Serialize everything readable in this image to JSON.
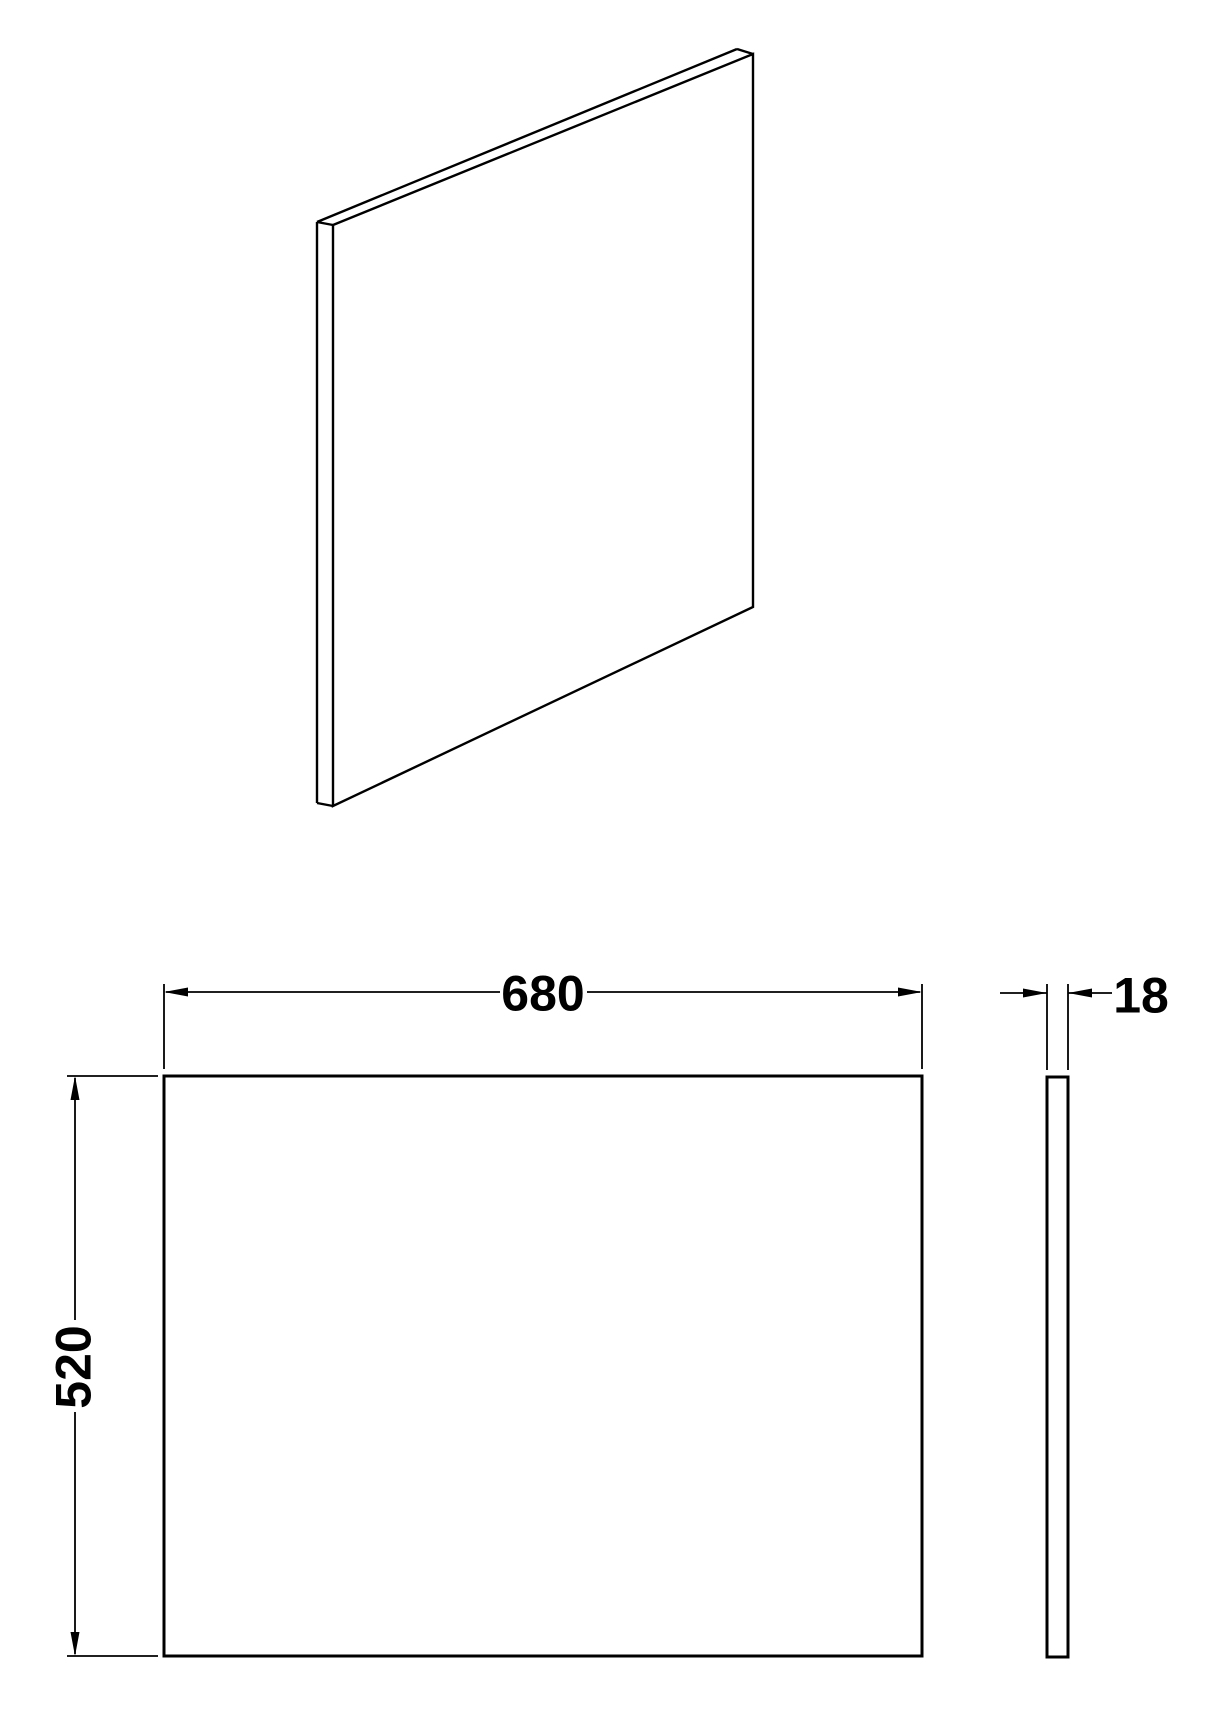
{
  "drawing": {
    "background_color": "#ffffff",
    "line_color": "#000000",
    "dimension_labels": {
      "width": "680",
      "height": "520",
      "thickness": "18"
    }
  }
}
